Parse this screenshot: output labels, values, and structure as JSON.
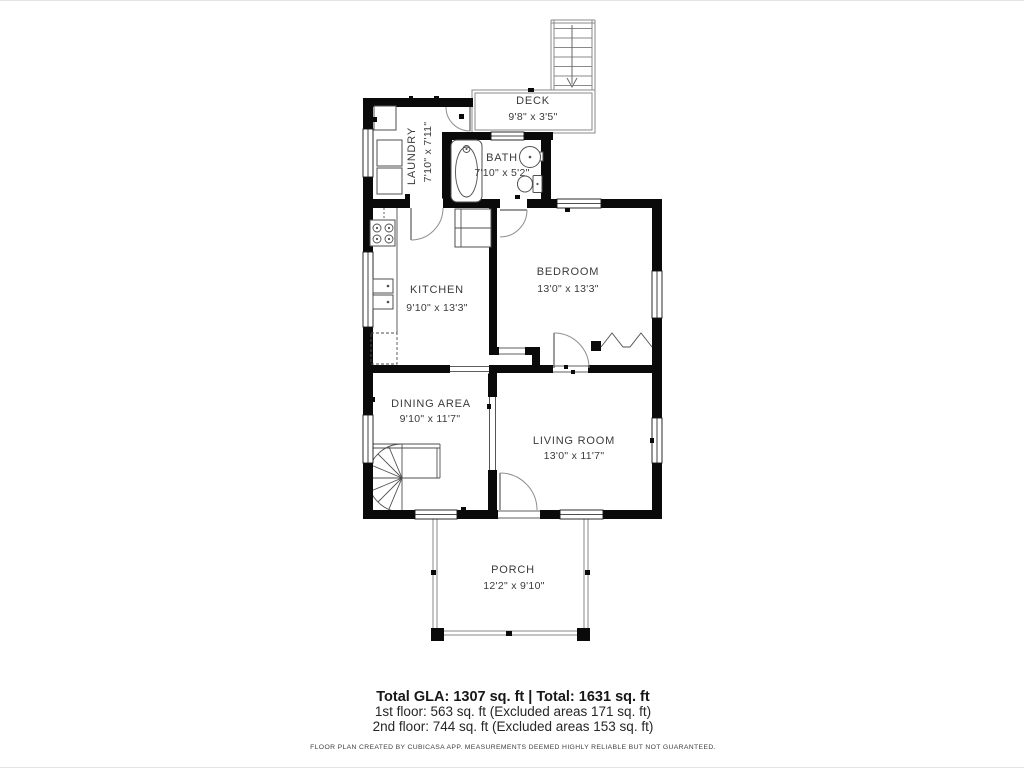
{
  "rooms": [
    {
      "id": "deck",
      "name": "DECK",
      "dims": "9'8\" x 3'5\""
    },
    {
      "id": "laundry",
      "name": "LAUNDRY",
      "dims": "7'10\" x 7'11\""
    },
    {
      "id": "bath",
      "name": "BATH",
      "dims": "7'10\" x 5'2\""
    },
    {
      "id": "kitchen",
      "name": "KITCHEN",
      "dims": "9'10\" x 13'3\""
    },
    {
      "id": "bedroom",
      "name": "BEDROOM",
      "dims": "13'0\" x 13'3\""
    },
    {
      "id": "dining",
      "name": "DINING AREA",
      "dims": "9'10\" x 11'7\""
    },
    {
      "id": "living",
      "name": "LIVING ROOM",
      "dims": "13'0\" x 11'7\""
    },
    {
      "id": "porch",
      "name": "PORCH",
      "dims": "12'2\" x 9'10\""
    }
  ],
  "summary": {
    "total": "Total GLA: 1307 sq. ft | Total: 1631 sq. ft",
    "first_floor": "1st floor: 563 sq. ft (Excluded areas 171 sq. ft)",
    "second_floor": "2nd floor: 744 sq. ft (Excluded areas 153 sq. ft)",
    "disclaimer": "FLOOR PLAN CREATED BY CUBICASA APP. MEASUREMENTS DEEMED HIGHLY RELIABLE BUT NOT GUARANTEED."
  },
  "colors": {
    "wall": "#0a0a0a",
    "fixture": "#4f4f4f",
    "railing": "#8a8a8a",
    "text": "#3b3b3b"
  }
}
